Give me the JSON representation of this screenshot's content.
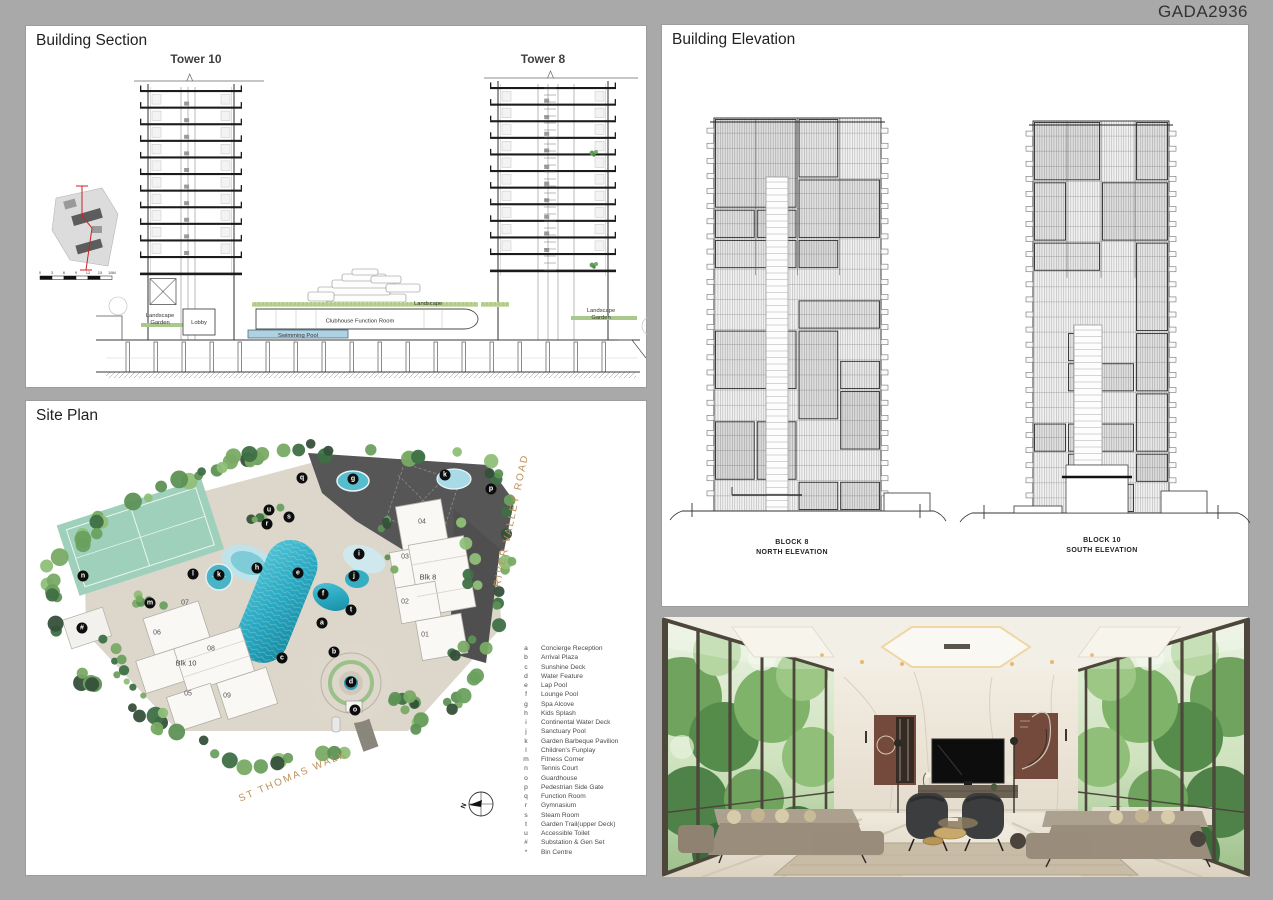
{
  "watermark": "GADA2936",
  "colors": {
    "background": "#a9a9a9",
    "panel": "#ffffff",
    "street_text": "#bd9058",
    "pool": "#2ba9c2",
    "pool_light": "#bfe2ea",
    "tennis": "#9fd0bc",
    "marker_bg": "#0d0d0d",
    "landscape_green": "#a9c98a",
    "artwork_maroon": "#744a3c"
  },
  "section": {
    "title": "Building Section",
    "tower_left": "Tower 10",
    "tower_right": "Tower 8",
    "labels": {
      "landscape": "Landscape",
      "landscape_garden_line1": "Landscape",
      "landscape_garden_line2": "Garden",
      "lobby": "Lobby",
      "clubhouse": "Clubhouse Function Room",
      "swimming_pool": "Swimming Pool"
    },
    "scalebar": [
      "0",
      "3",
      "6",
      "9",
      "12",
      "15",
      "18M"
    ]
  },
  "site_plan": {
    "title": "Site Plan",
    "street_right": "RIVER VALLEY ROAD",
    "street_bottom": "ST THOMAS WALK",
    "north_label": "N",
    "blocks": [
      {
        "name": "Blk 8",
        "units": [
          "01",
          "02",
          "03",
          "04"
        ]
      },
      {
        "name": "Blk 10",
        "units": [
          "05",
          "06",
          "07",
          "08",
          "09"
        ]
      }
    ],
    "units": [
      {
        "label": "04",
        "x": 396,
        "y": 121
      },
      {
        "label": "03",
        "x": 379,
        "y": 156
      },
      {
        "label": "Blk 8",
        "x": 402,
        "y": 176,
        "blk": true
      },
      {
        "label": "02",
        "x": 379,
        "y": 201
      },
      {
        "label": "01",
        "x": 399,
        "y": 234
      },
      {
        "label": "07",
        "x": 159,
        "y": 202
      },
      {
        "label": "06",
        "x": 131,
        "y": 232
      },
      {
        "label": "08",
        "x": 185,
        "y": 248
      },
      {
        "label": "Blk 10",
        "x": 160,
        "y": 262,
        "blk": true
      },
      {
        "label": "05",
        "x": 162,
        "y": 293
      },
      {
        "label": "09",
        "x": 201,
        "y": 295
      }
    ],
    "markers": [
      {
        "letter": "q",
        "x": 276,
        "y": 77
      },
      {
        "letter": "g",
        "x": 327,
        "y": 78
      },
      {
        "letter": "k",
        "x": 419,
        "y": 74
      },
      {
        "letter": "p",
        "x": 465,
        "y": 88
      },
      {
        "letter": "u",
        "x": 243,
        "y": 109
      },
      {
        "letter": "s",
        "x": 263,
        "y": 116
      },
      {
        "letter": "r",
        "x": 241,
        "y": 123
      },
      {
        "letter": "i",
        "x": 333,
        "y": 153
      },
      {
        "letter": "h",
        "x": 231,
        "y": 167
      },
      {
        "letter": "l",
        "x": 167,
        "y": 173
      },
      {
        "letter": "k",
        "x": 193,
        "y": 174
      },
      {
        "letter": "e",
        "x": 272,
        "y": 172
      },
      {
        "letter": "j",
        "x": 328,
        "y": 175
      },
      {
        "letter": "n",
        "x": 57,
        "y": 175
      },
      {
        "letter": "f",
        "x": 297,
        "y": 193
      },
      {
        "letter": "m",
        "x": 124,
        "y": 202
      },
      {
        "letter": "t",
        "x": 325,
        "y": 209
      },
      {
        "letter": "a",
        "x": 296,
        "y": 222
      },
      {
        "letter": "#",
        "x": 56,
        "y": 227
      },
      {
        "letter": "b",
        "x": 308,
        "y": 251
      },
      {
        "letter": "c",
        "x": 256,
        "y": 257
      },
      {
        "letter": "d",
        "x": 325,
        "y": 281
      },
      {
        "letter": "o",
        "x": 329,
        "y": 309
      }
    ],
    "legend": [
      {
        "key": "a",
        "label": "Concierge Reception"
      },
      {
        "key": "b",
        "label": "Arrival Plaza"
      },
      {
        "key": "c",
        "label": "Sunshine Deck"
      },
      {
        "key": "d",
        "label": "Water Feature"
      },
      {
        "key": "e",
        "label": "Lap Pool"
      },
      {
        "key": "f",
        "label": "Lounge Pool"
      },
      {
        "key": "g",
        "label": "Spa Alcove"
      },
      {
        "key": "h",
        "label": "Kids Splash"
      },
      {
        "key": "i",
        "label": "Continental Water Deck"
      },
      {
        "key": "j",
        "label": "Sanctuary Pool"
      },
      {
        "key": "k",
        "label": "Garden Barbeque Pavilion"
      },
      {
        "key": "l",
        "label": "Children's Funplay"
      },
      {
        "key": "m",
        "label": "Fitness Corner"
      },
      {
        "key": "n",
        "label": "Tennis Court"
      },
      {
        "key": "o",
        "label": "Guardhouse"
      },
      {
        "key": "p",
        "label": "Pedestrian Side Gate"
      },
      {
        "key": "q",
        "label": "Function Room"
      },
      {
        "key": "r",
        "label": "Gymnasium"
      },
      {
        "key": "s",
        "label": "Steam Room"
      },
      {
        "key": "t",
        "label": "Garden Trail(upper Deck)"
      },
      {
        "key": "u",
        "label": "Accessible Toilet"
      },
      {
        "key": "#",
        "label": "Substation & Gen Set"
      },
      {
        "key": "*",
        "label": "Bin Centre"
      }
    ]
  },
  "elevation": {
    "title": "Building Elevation",
    "left_block": "BLOCK 8",
    "left_view": "NORTH ELEVATION",
    "right_block": "BLOCK 10",
    "right_view": "SOUTH ELEVATION"
  }
}
